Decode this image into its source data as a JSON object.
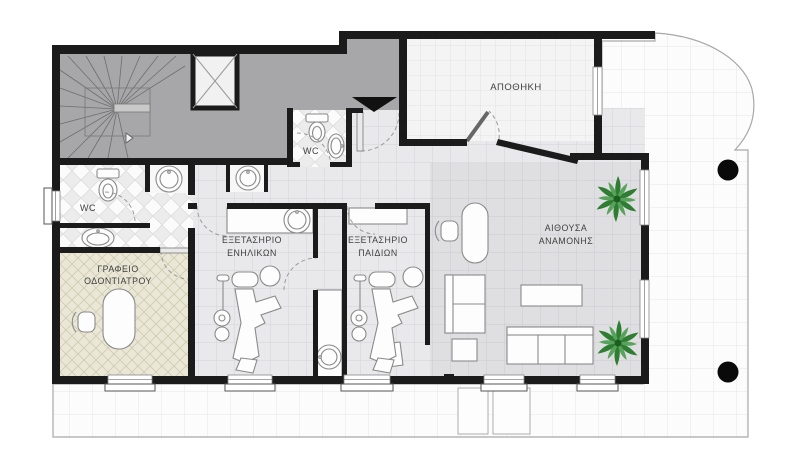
{
  "floor_plan": {
    "rooms": {
      "storage": {
        "label": "ΑΠΟΘΗΚΗ"
      },
      "wc_entrance": {
        "label": "WC"
      },
      "wc_office": {
        "label": "WC"
      },
      "dentist_office": {
        "line1": "ΓΡΑΦΕΙΟ",
        "line2": "ΟΔΟΝΤΙΑΤΡΟΥ"
      },
      "exam_adults": {
        "line1": "ΕΞΕΤΑΣΗΡΙΟ",
        "line2": "ΕΝΗΛΙΚΩΝ"
      },
      "exam_children": {
        "line1": "ΕΞΕΤΑΣΗΡΙΟ",
        "line2": "ΠΑΙΔΙΩΝ"
      },
      "waiting_room": {
        "line1": "ΑΙΘΟΥΣΑ",
        "line2": "ΑΝΑΜΟΝΗΣ"
      }
    },
    "colors": {
      "walls": "#1b1b1b",
      "common_area": "#a7a7a9",
      "interior_floor": "#e9e9ec",
      "waiting_floor": "#dfdfe2",
      "office_floor": "#eae7d7",
      "storage_floor": "#f4f4f4",
      "balcony_floor": "#fcfcfc",
      "plant_green": "#2e7d32",
      "column": "#0a0a0a"
    }
  }
}
